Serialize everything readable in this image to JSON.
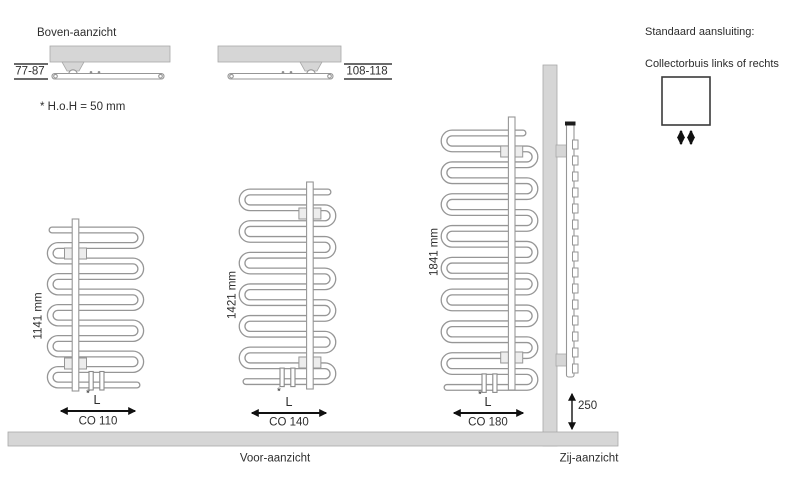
{
  "top_view": {
    "title": "Boven-aanzicht",
    "left_dimension": "77-87",
    "right_dimension": "108-118",
    "note": "* H.o.H = 50 mm"
  },
  "front_view": {
    "label": "Voor-aanzicht",
    "radiators": [
      {
        "height": "1141 mm",
        "width_label": "L",
        "model": "CO 110",
        "footnote_marker": "*"
      },
      {
        "height": "1421 mm",
        "width_label": "L",
        "model": "CO 140",
        "footnote_marker": "*"
      },
      {
        "height": "1841 mm",
        "width_label": "L",
        "model": "CO 180",
        "footnote_marker": "*"
      }
    ]
  },
  "side_view": {
    "label": "Zij-aanzicht",
    "floor_clearance": "250"
  },
  "connection_panel": {
    "heading": "Standaard aansluiting:",
    "description": "Collectorbuis links of rechts"
  },
  "colors": {
    "fill_gray": "#d6d6d6",
    "line_gray": "#969696",
    "arrow_black": "#111111",
    "text": "#2e2e2e"
  }
}
